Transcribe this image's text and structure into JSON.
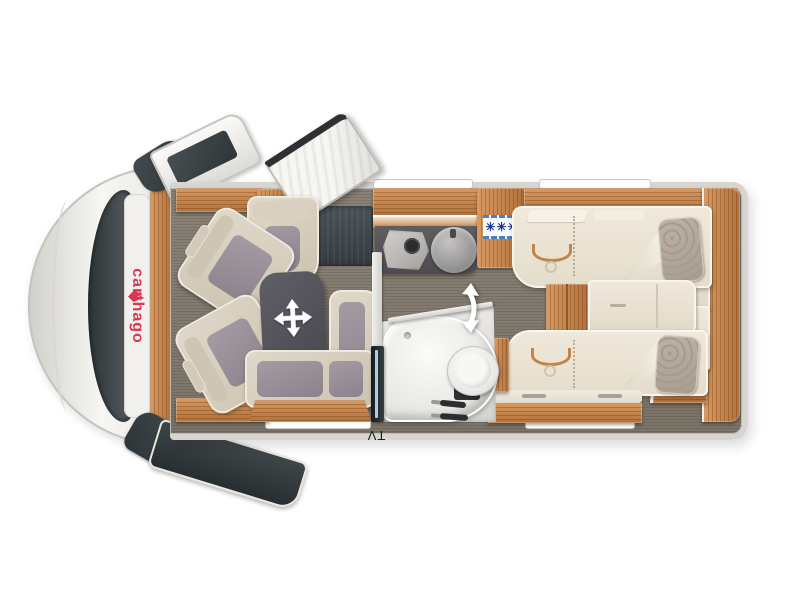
{
  "meta": {
    "view": "motorhome-floorplan-top-view",
    "orientation": "cab-left-rear-right"
  },
  "branding": {
    "logo_text": "carthago",
    "logo_color": "#dc3553"
  },
  "labels": {
    "tv": "TV"
  },
  "icons": {
    "fridge_frost": "✳✳✳",
    "table_move": "four-way-move-arrow",
    "swivel_wall": "curved-double-arrow",
    "fridge_frost_color": "#1d2f8a"
  },
  "palette": {
    "body_white": "#f4f4f1",
    "wall_gray": "#d6d5d0",
    "floor_wood": "#837b6f",
    "furniture_wood": "#bf7d45",
    "upholstery_beige": "#d8cfc0",
    "upholstery_gray": "#948c95",
    "table_gray": "#53525a",
    "step_mat": "#3c4347",
    "bath_white": "#f2f1ee"
  },
  "rooms": {
    "cab": {
      "features": [
        "windshield",
        "dashboard",
        "driver-swivel-seat",
        "passenger-swivel-seat",
        "left-mirror",
        "right-mirror",
        "cab-doors"
      ]
    },
    "lounge": {
      "features": [
        "side-bench-seat",
        "movable-table",
        "l-shaped-bench",
        "entry-door-open",
        "entry-step-mat",
        "overhead-cabinet"
      ]
    },
    "kitchen": {
      "features": [
        "worktop",
        "hob",
        "round-sink",
        "refrigerator-with-freezer-symbol"
      ]
    },
    "bathroom": {
      "features": [
        "swivel-wall",
        "shower-tray",
        "toilet",
        "taps",
        "tv-panel-on-wall"
      ]
    },
    "bedroom": {
      "features": [
        "single-bed-upper",
        "single-bed-lower",
        "bed-steps",
        "bedside-chest",
        "rear-wardrobes",
        "rear-shelf"
      ]
    }
  }
}
